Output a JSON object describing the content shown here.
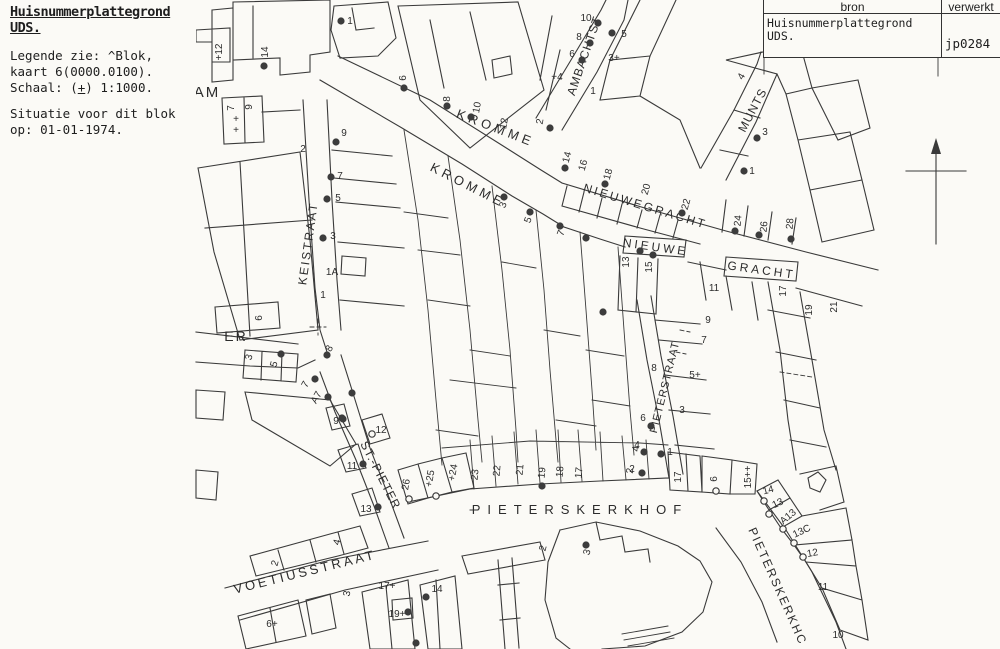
{
  "info": {
    "title": "Huisnummerplattegrond UDS.",
    "legend_line1": "Legende zie: ^Blok,",
    "legend_line2": "kaart 6(0000.0100).",
    "schaal_pre": "Schaal: (",
    "schaal_plus": "+",
    "schaal_post": ") 1:1000.",
    "situatie_line1": "Situatie voor dit blok",
    "situatie_line2": "op: 01-01-1974."
  },
  "source_table": {
    "col1_header": "bron",
    "col2_header": "verwerkt",
    "col1_value": "Huisnummerplattegrond UDS.",
    "col2_value": "jp0284"
  },
  "map": {
    "icons": [
      "north-arrow-icon"
    ],
    "street_labels": [
      {
        "t": "AM",
        "x": 207,
        "y": 97,
        "r": 0,
        "s": 15,
        "ls": 2
      },
      {
        "t": "ER",
        "x": 236,
        "y": 341,
        "r": 0,
        "s": 14,
        "ls": 2
      },
      {
        "t": "KROMME",
        "x": 494,
        "y": 132,
        "r": 21,
        "s": 13,
        "ls": 4
      },
      {
        "t": "KROMME",
        "x": 466,
        "y": 189,
        "r": 27,
        "s": 13,
        "ls": 4
      },
      {
        "t": "NIEUWEGRACHT",
        "x": 644,
        "y": 210,
        "r": 17,
        "s": 12,
        "ls": 2.5
      },
      {
        "t": "NIEUWE",
        "x": 655,
        "y": 251,
        "r": 8,
        "s": 12,
        "ls": 3
      },
      {
        "t": "GRACHT",
        "x": 761,
        "y": 274,
        "r": 8,
        "s": 12,
        "ls": 3
      },
      {
        "t": "AMBACHTST",
        "x": 588,
        "y": 57,
        "r": -71,
        "s": 12,
        "ls": 1
      },
      {
        "t": "MUNTS",
        "x": 756,
        "y": 112,
        "r": -62,
        "s": 12,
        "ls": 1
      },
      {
        "t": "KEISTRAAT",
        "x": 312,
        "y": 244,
        "r": -82,
        "s": 12,
        "ls": 2
      },
      {
        "t": "PIETERSTRAAT",
        "x": 668,
        "y": 388,
        "r": -76,
        "s": 11,
        "ls": 1
      },
      {
        "t": "ST.-PIETER",
        "x": 377,
        "y": 477,
        "r": 63,
        "s": 12,
        "ls": 1
      },
      {
        "t": "PIETERSKERKHOF",
        "x": 580,
        "y": 514,
        "r": 0,
        "s": 13,
        "ls": 7
      },
      {
        "t": "VOETIUSSTRAAT",
        "x": 306,
        "y": 576,
        "r": -14,
        "s": 13,
        "ls": 3
      },
      {
        "t": "PIETERSKERKHC",
        "x": 774,
        "y": 588,
        "r": 66,
        "s": 12,
        "ls": 2
      }
    ],
    "numbers": [
      {
        "t": "+12",
        "x": 222,
        "y": 52,
        "r": -90
      },
      {
        "t": "14",
        "x": 268,
        "y": 52,
        "r": -90
      },
      {
        "t": "7",
        "x": 234,
        "y": 108,
        "r": -90
      },
      {
        "t": "+",
        "x": 236,
        "y": 122,
        "r": 0
      },
      {
        "t": "+",
        "x": 236,
        "y": 133,
        "r": 0
      },
      {
        "t": "9",
        "x": 252,
        "y": 107,
        "r": -90
      },
      {
        "t": "2",
        "x": 303,
        "y": 152,
        "r": 0
      },
      {
        "t": "6",
        "x": 262,
        "y": 318,
        "r": -90
      },
      {
        "t": "3",
        "x": 252,
        "y": 358,
        "r": -75
      },
      {
        "t": "5",
        "x": 277,
        "y": 365,
        "r": -75
      },
      {
        "t": "7",
        "x": 308,
        "y": 386,
        "r": -60
      },
      {
        "t": "A7",
        "x": 319,
        "y": 399,
        "r": -60
      },
      {
        "t": "8",
        "x": 332,
        "y": 350,
        "r": -60
      },
      {
        "t": "1",
        "x": 323,
        "y": 298,
        "r": 0
      },
      {
        "t": "9",
        "x": 336,
        "y": 424,
        "r": 0
      },
      {
        "t": "11",
        "x": 352,
        "y": 469,
        "r": 0
      },
      {
        "t": "13",
        "x": 366,
        "y": 512,
        "r": 0
      },
      {
        "t": "12",
        "x": 381,
        "y": 433,
        "r": 0
      },
      {
        "t": "9",
        "x": 344,
        "y": 136,
        "r": 0
      },
      {
        "t": "7",
        "x": 340,
        "y": 179,
        "r": 0
      },
      {
        "t": "5",
        "x": 338,
        "y": 201,
        "r": 0
      },
      {
        "t": "3",
        "x": 333,
        "y": 239,
        "r": 0
      },
      {
        "t": "1A",
        "x": 332,
        "y": 275,
        "r": 0
      },
      {
        "t": "1",
        "x": 350,
        "y": 24,
        "r": 0
      },
      {
        "t": "6",
        "x": 406,
        "y": 78,
        "r": -90
      },
      {
        "t": "8",
        "x": 450,
        "y": 99,
        "r": -90
      },
      {
        "t": "10",
        "x": 480,
        "y": 108,
        "r": -80
      },
      {
        "t": "12",
        "x": 507,
        "y": 124,
        "r": -80
      },
      {
        "t": "2",
        "x": 543,
        "y": 122,
        "r": -80
      },
      {
        "t": "10",
        "x": 586,
        "y": 21,
        "r": 0
      },
      {
        "t": "8",
        "x": 579,
        "y": 40,
        "r": 0
      },
      {
        "t": "6",
        "x": 572,
        "y": 57,
        "r": 0
      },
      {
        "t": "5",
        "x": 624,
        "y": 37,
        "r": 0
      },
      {
        "t": "3+",
        "x": 614,
        "y": 61,
        "r": 0
      },
      {
        "t": "+4",
        "x": 557,
        "y": 80,
        "r": 0
      },
      {
        "t": "1",
        "x": 593,
        "y": 94,
        "r": 0
      },
      {
        "t": "14",
        "x": 570,
        "y": 158,
        "r": -75
      },
      {
        "t": "16",
        "x": 586,
        "y": 166,
        "r": -75
      },
      {
        "t": "18",
        "x": 611,
        "y": 175,
        "r": -75
      },
      {
        "t": "20",
        "x": 649,
        "y": 190,
        "r": -75
      },
      {
        "t": "22",
        "x": 689,
        "y": 205,
        "r": -75
      },
      {
        "t": "3",
        "x": 506,
        "y": 206,
        "r": -70
      },
      {
        "t": "5",
        "x": 531,
        "y": 221,
        "r": -70
      },
      {
        "t": "7",
        "x": 564,
        "y": 234,
        "r": -70
      },
      {
        "t": "4",
        "x": 744,
        "y": 78,
        "r": -60
      },
      {
        "t": "3",
        "x": 765,
        "y": 135,
        "r": 0
      },
      {
        "t": "1",
        "x": 752,
        "y": 174,
        "r": 0
      },
      {
        "t": "24",
        "x": 741,
        "y": 221,
        "r": -85
      },
      {
        "t": "26",
        "x": 767,
        "y": 227,
        "r": -85
      },
      {
        "t": "28",
        "x": 793,
        "y": 224,
        "r": -85
      },
      {
        "t": "13",
        "x": 629,
        "y": 262,
        "r": -90
      },
      {
        "t": "15",
        "x": 652,
        "y": 267,
        "r": -90
      },
      {
        "t": "11",
        "x": 714,
        "y": 291,
        "r": 0
      },
      {
        "t": "9",
        "x": 708,
        "y": 323,
        "r": 0
      },
      {
        "t": "7",
        "x": 704,
        "y": 343,
        "r": 0
      },
      {
        "t": "5+",
        "x": 695,
        "y": 378,
        "r": 0
      },
      {
        "t": "3",
        "x": 682,
        "y": 413,
        "r": 0
      },
      {
        "t": "1",
        "x": 670,
        "y": 455,
        "r": 0
      },
      {
        "t": "8",
        "x": 654,
        "y": 371,
        "r": 0
      },
      {
        "t": "6",
        "x": 643,
        "y": 421,
        "r": 0
      },
      {
        "t": "4",
        "x": 637,
        "y": 448,
        "r": 0
      },
      {
        "t": "2",
        "x": 632,
        "y": 472,
        "r": 0
      },
      {
        "t": "17",
        "x": 786,
        "y": 291,
        "r": -90
      },
      {
        "t": "19",
        "x": 812,
        "y": 310,
        "r": -90
      },
      {
        "t": "21",
        "x": 837,
        "y": 307,
        "r": -90
      },
      {
        "t": "17",
        "x": 681,
        "y": 477,
        "r": -90
      },
      {
        "t": "6",
        "x": 717,
        "y": 479,
        "r": -90
      },
      {
        "t": "15++",
        "x": 751,
        "y": 477,
        "r": -90
      },
      {
        "t": "23",
        "x": 478,
        "y": 475,
        "r": -85
      },
      {
        "t": "22",
        "x": 500,
        "y": 471,
        "r": -85
      },
      {
        "t": "21",
        "x": 523,
        "y": 470,
        "r": -85
      },
      {
        "t": "19",
        "x": 545,
        "y": 473,
        "r": -85
      },
      {
        "t": "18",
        "x": 563,
        "y": 472,
        "r": -85
      },
      {
        "t": "17",
        "x": 582,
        "y": 473,
        "r": -85
      },
      {
        "t": "2",
        "x": 633,
        "y": 471,
        "r": -85
      },
      {
        "t": "4",
        "x": 639,
        "y": 449,
        "r": -85
      },
      {
        "t": "26",
        "x": 409,
        "y": 485,
        "r": -80
      },
      {
        "t": "+25",
        "x": 433,
        "y": 479,
        "r": -80
      },
      {
        "t": "+24",
        "x": 456,
        "y": 473,
        "r": -80
      },
      {
        "t": "2",
        "x": 278,
        "y": 564,
        "r": -75
      },
      {
        "t": "4",
        "x": 340,
        "y": 543,
        "r": -75
      },
      {
        "t": "6+",
        "x": 272,
        "y": 627,
        "r": 0
      },
      {
        "t": "3",
        "x": 350,
        "y": 594,
        "r": -80
      },
      {
        "t": "17+",
        "x": 387,
        "y": 589,
        "r": 0
      },
      {
        "t": "19+",
        "x": 397,
        "y": 617,
        "r": 0
      },
      {
        "t": "14",
        "x": 437,
        "y": 592,
        "r": 0
      },
      {
        "t": "2",
        "x": 546,
        "y": 549,
        "r": -75
      },
      {
        "t": "3",
        "x": 590,
        "y": 553,
        "r": -75
      },
      {
        "t": "14",
        "x": 769,
        "y": 493,
        "r": -15
      },
      {
        "t": "13",
        "x": 779,
        "y": 506,
        "r": -25
      },
      {
        "t": "A13",
        "x": 790,
        "y": 519,
        "r": -40
      },
      {
        "t": "13C",
        "x": 803,
        "y": 534,
        "r": -25
      },
      {
        "t": "12",
        "x": 813,
        "y": 556,
        "r": -10
      },
      {
        "t": "11",
        "x": 823,
        "y": 590,
        "r": 0
      },
      {
        "t": "10",
        "x": 838,
        "y": 638,
        "r": 0
      }
    ],
    "dots": [
      {
        "x": 264,
        "y": 66
      },
      {
        "x": 341,
        "y": 21
      },
      {
        "x": 404,
        "y": 88
      },
      {
        "x": 447,
        "y": 106
      },
      {
        "x": 471,
        "y": 117
      },
      {
        "x": 550,
        "y": 128
      },
      {
        "x": 598,
        "y": 23
      },
      {
        "x": 590,
        "y": 43
      },
      {
        "x": 582,
        "y": 60
      },
      {
        "x": 612,
        "y": 33
      },
      {
        "x": 565,
        "y": 168
      },
      {
        "x": 605,
        "y": 184
      },
      {
        "x": 682,
        "y": 213
      },
      {
        "x": 504,
        "y": 197
      },
      {
        "x": 530,
        "y": 212
      },
      {
        "x": 560,
        "y": 226
      },
      {
        "x": 586,
        "y": 238
      },
      {
        "x": 757,
        "y": 138
      },
      {
        "x": 744,
        "y": 171
      },
      {
        "x": 735,
        "y": 231
      },
      {
        "x": 759,
        "y": 235
      },
      {
        "x": 791,
        "y": 239
      },
      {
        "x": 640,
        "y": 251
      },
      {
        "x": 653,
        "y": 255
      },
      {
        "x": 603,
        "y": 312
      },
      {
        "x": 651,
        "y": 426
      },
      {
        "x": 644,
        "y": 452
      },
      {
        "x": 642,
        "y": 473
      },
      {
        "x": 661,
        "y": 454
      },
      {
        "x": 343,
        "y": 419
      },
      {
        "x": 363,
        "y": 464
      },
      {
        "x": 378,
        "y": 507
      },
      {
        "x": 336,
        "y": 142
      },
      {
        "x": 331,
        "y": 177
      },
      {
        "x": 327,
        "y": 199
      },
      {
        "x": 323,
        "y": 238
      },
      {
        "x": 327,
        "y": 355
      },
      {
        "x": 281,
        "y": 354
      },
      {
        "x": 315,
        "y": 379
      },
      {
        "x": 328,
        "y": 397
      },
      {
        "x": 342,
        "y": 418
      },
      {
        "x": 352,
        "y": 393
      },
      {
        "x": 542,
        "y": 486
      },
      {
        "x": 426,
        "y": 597
      },
      {
        "x": 408,
        "y": 612
      },
      {
        "x": 416,
        "y": 643
      },
      {
        "x": 586,
        "y": 545
      }
    ],
    "door_circles": [
      {
        "x": 372,
        "y": 434
      },
      {
        "x": 409,
        "y": 499
      },
      {
        "x": 436,
        "y": 496
      },
      {
        "x": 716,
        "y": 491
      },
      {
        "x": 764,
        "y": 501
      },
      {
        "x": 769,
        "y": 514
      },
      {
        "x": 783,
        "y": 529
      },
      {
        "x": 794,
        "y": 543
      },
      {
        "x": 803,
        "y": 557
      }
    ]
  }
}
